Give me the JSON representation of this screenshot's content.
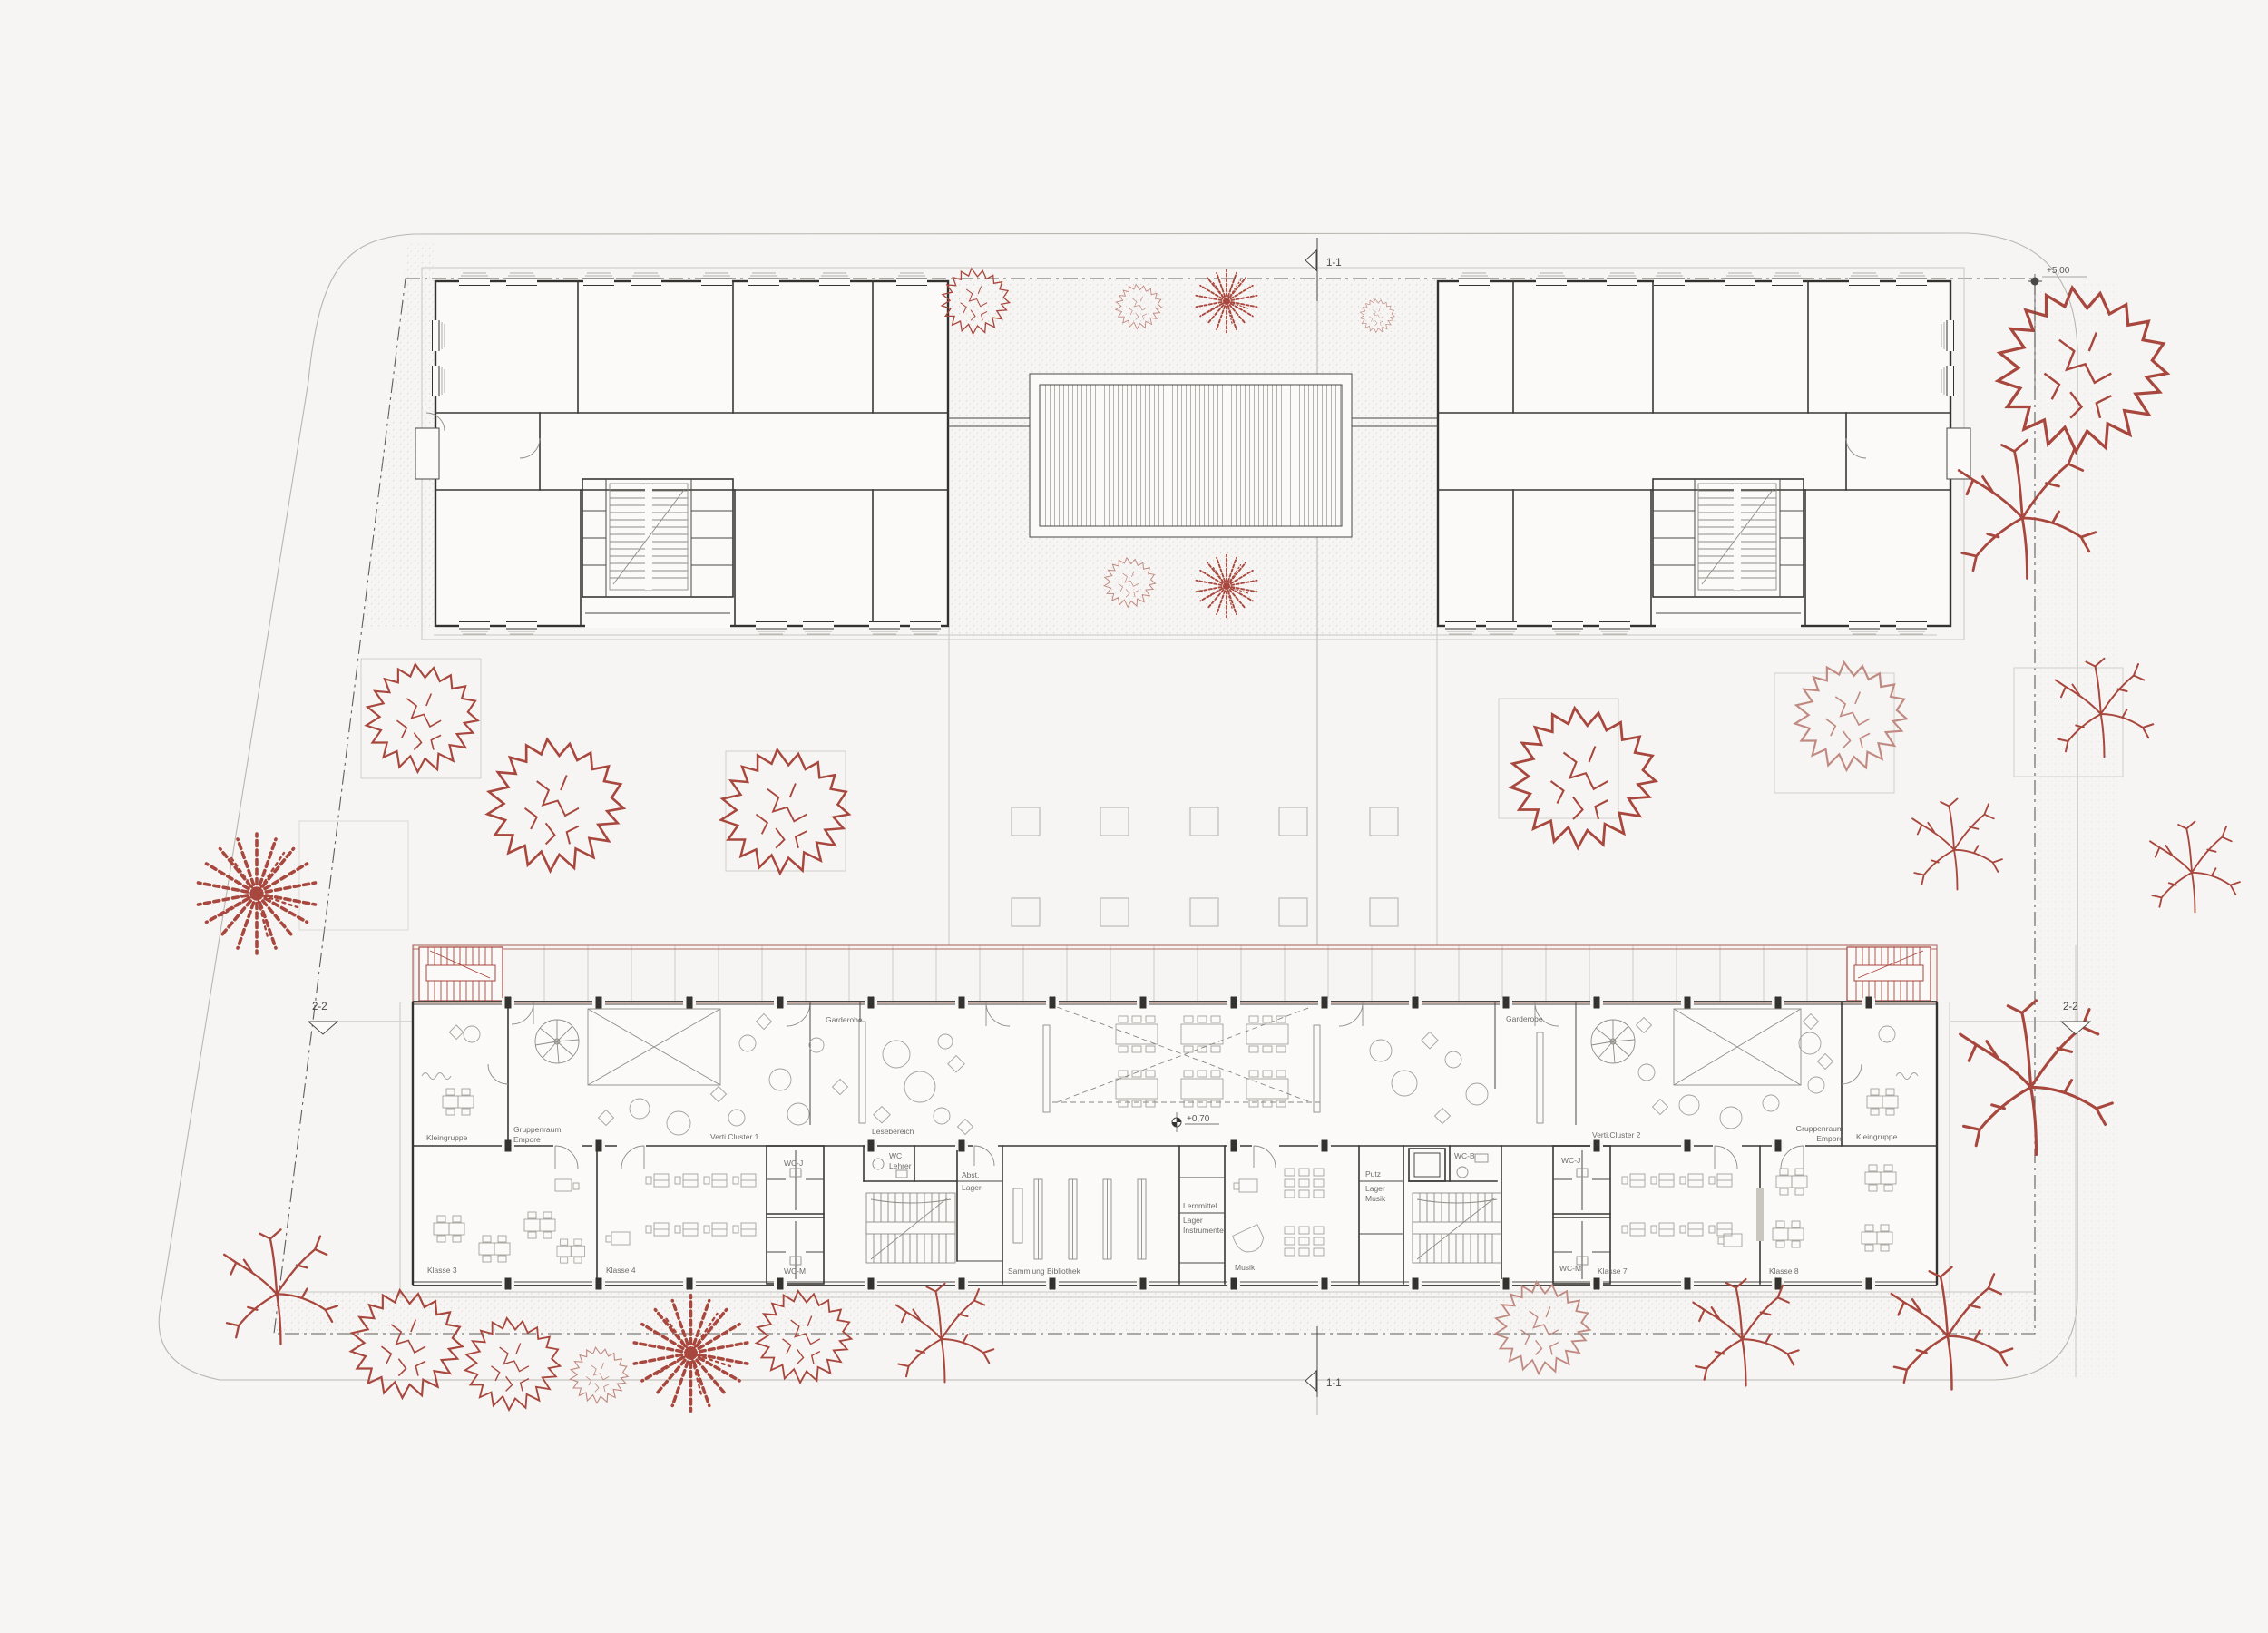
{
  "plan": {
    "title": "Schule – Grundriss Lageplan",
    "colors": {
      "background": "#f6f5f3",
      "ink": "#34322e",
      "light_line": "#cac7c1",
      "label": "#6f6c68",
      "tree_red": "#a8473d",
      "upper_level_red": "#b06a60"
    },
    "sections": {
      "top": "1-1",
      "bottom": "1-1",
      "left": "2-2",
      "right": "2-2"
    },
    "levels": {
      "site": "+5,00",
      "ground_floor": "+0,70"
    },
    "left_cluster": {
      "kleingruppe": "Kleingruppe",
      "gruppenraum": "Gruppenraum",
      "empore": "Empore",
      "cluster": "Verti.Cluster 1",
      "garderobe": "Garderobe",
      "wc_j": "WC-J",
      "wc_m": "WC-M",
      "klasse_a": "Klasse 3",
      "klasse_b": "Klasse 4"
    },
    "center": {
      "lesebereich": "Lesebereich",
      "wc": "WC",
      "lehrer": "Lehrer",
      "abst": "Abst.",
      "lager": "Lager",
      "bibliothek": "Sammlung Bibliothek",
      "lernmittel": "Lernmittel",
      "lager_instr_1": "Lager",
      "lager_instr_2": "Instrumente",
      "musik": "Musik",
      "putz": "Putz",
      "lager_musik_1": "Lager",
      "lager_musik_2": "Musik",
      "wc_b": "WC-B"
    },
    "right_cluster": {
      "cluster": "Verti.Cluster 2",
      "garderobe": "Garderobe",
      "wc_j": "WC-J",
      "wc_m": "WC-M",
      "klasse_a": "Klasse 7",
      "klasse_b": "Klasse 8",
      "gruppenraum": "Gruppenraum",
      "empore": "Empore",
      "kleingruppe": "Kleingruppe"
    }
  }
}
